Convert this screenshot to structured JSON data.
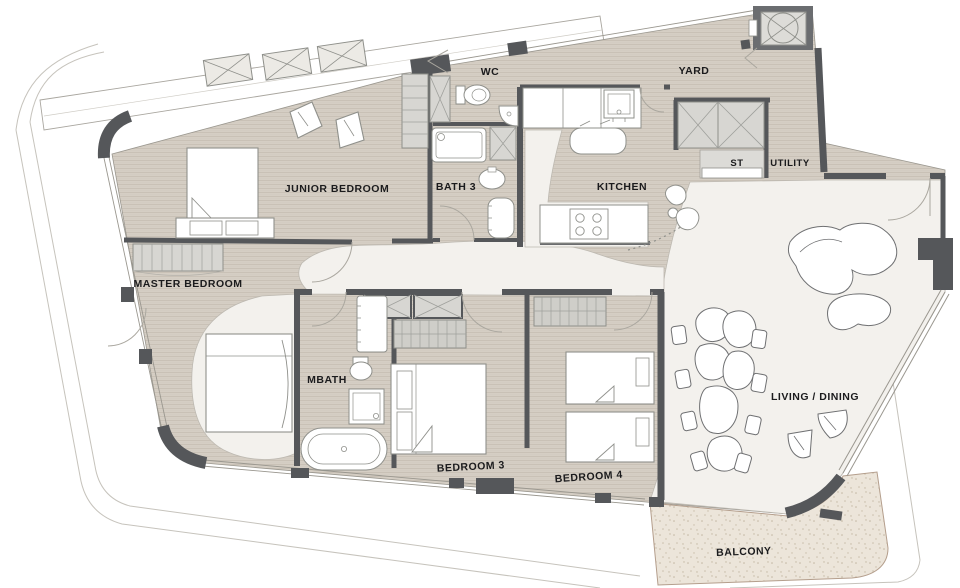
{
  "plan": {
    "type": "apartment-floor-plan",
    "colors": {
      "wall_dark": "#55575a",
      "wall_medium": "#8b8d90",
      "wood_floor": "#d5cec4",
      "wood_stripe": "#c8c0b5",
      "hall_floor": "#f3f1ed",
      "balcony_floor": "#ece5da",
      "closet_fill": "#d7d6d2",
      "fixture_line": "#8f908b",
      "label_text": "#1b1b1d"
    },
    "rooms": [
      {
        "id": "junior-bedroom",
        "label": "JUNIOR BEDROOM"
      },
      {
        "id": "master-bedroom",
        "label": "MASTER BEDROOM"
      },
      {
        "id": "wc",
        "label": "WC"
      },
      {
        "id": "bath-3",
        "label": "BATH 3"
      },
      {
        "id": "kitchen",
        "label": "KITCHEN"
      },
      {
        "id": "yard",
        "label": "YARD"
      },
      {
        "id": "st",
        "label": "ST"
      },
      {
        "id": "utility",
        "label": "UTILITY"
      },
      {
        "id": "mbath",
        "label": "MBATH"
      },
      {
        "id": "bedroom-3",
        "label": "BEDROOM 3"
      },
      {
        "id": "bedroom-4",
        "label": "BEDROOM 4"
      },
      {
        "id": "living-dining",
        "label": "LIVING / DINING"
      },
      {
        "id": "balcony",
        "label": "BALCONY"
      }
    ]
  }
}
